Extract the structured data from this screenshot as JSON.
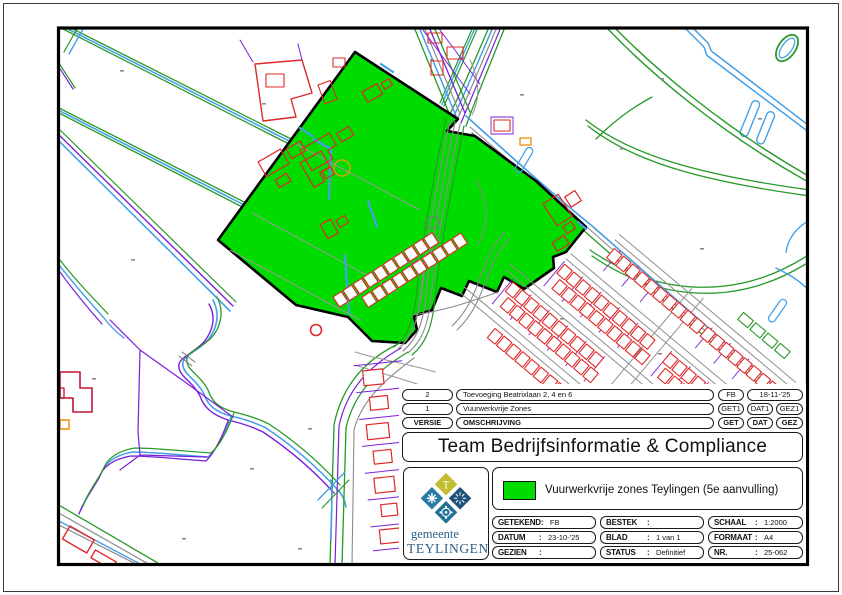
{
  "sheet": {
    "title": "Team Bedrijfsinformatie & Compliance",
    "legend": {
      "label": "Vuurwerkvrije zones Teylingen (5e aanvulling)",
      "swatch_color": "#00DC00"
    },
    "revision_table": {
      "rows": [
        {
          "versie": "2",
          "omschrijving": "Toevoeging Beatrixlaan 2, 4 en 6",
          "get": "FB",
          "dat": "18-11-'25"
        },
        {
          "versie": "1",
          "omschrijving": "Vuurwerkvrije Zones",
          "get": "GET1",
          "dat": "DAT1",
          "gez": "GEZ1"
        }
      ],
      "header": {
        "versie": "VERSIE",
        "omschrijving": "OMSCHRIJVING",
        "get": "GET",
        "dat": "DAT",
        "gez": "GEZ"
      }
    },
    "details": {
      "getekend": {
        "label": "GETEKEND",
        "sep": ":",
        "value": "FB"
      },
      "bestek": {
        "label": "BESTEK",
        "sep": ":",
        "value": ""
      },
      "schaal": {
        "label": "SCHAAL",
        "sep": ":",
        "value": "1:2000"
      },
      "datum": {
        "label": "DATUM",
        "sep": ":",
        "value": "23-10-'25"
      },
      "blad": {
        "label": "BLAD",
        "sep": ":",
        "value": "1 van 1"
      },
      "formaat": {
        "label": "FORMAAT",
        "sep": ":",
        "value": "A4"
      },
      "gezien": {
        "label": "GEZIEN",
        "sep": ":",
        "value": ""
      },
      "status": {
        "label": "STATUS",
        "sep": ":",
        "value": "Definitief"
      },
      "nr": {
        "label": "NR.",
        "sep": ":",
        "value": "25-062"
      }
    },
    "logo": {
      "caption_line1": "gemeente",
      "caption_line2": "TEYLINGEN",
      "colors": {
        "top": "#c2bc31",
        "left": "#2a7ca5",
        "right": "#1d5078",
        "bottom": "#1f6f96",
        "text": "#2d6187"
      }
    },
    "map": {
      "zone_fill": "#00DC00",
      "frame_color": "#000000",
      "line_colors": {
        "water": "#47A0E6",
        "vegetation": "#279927",
        "cadastral_purple": "#7B1FD9",
        "buildings_red": "#E02828",
        "buildings_dark_red": "#C41236",
        "roads_gray": "#8C8C8C",
        "accent_orange": "#F08A00",
        "pond_ring_yellow": "#D4A017"
      }
    }
  }
}
